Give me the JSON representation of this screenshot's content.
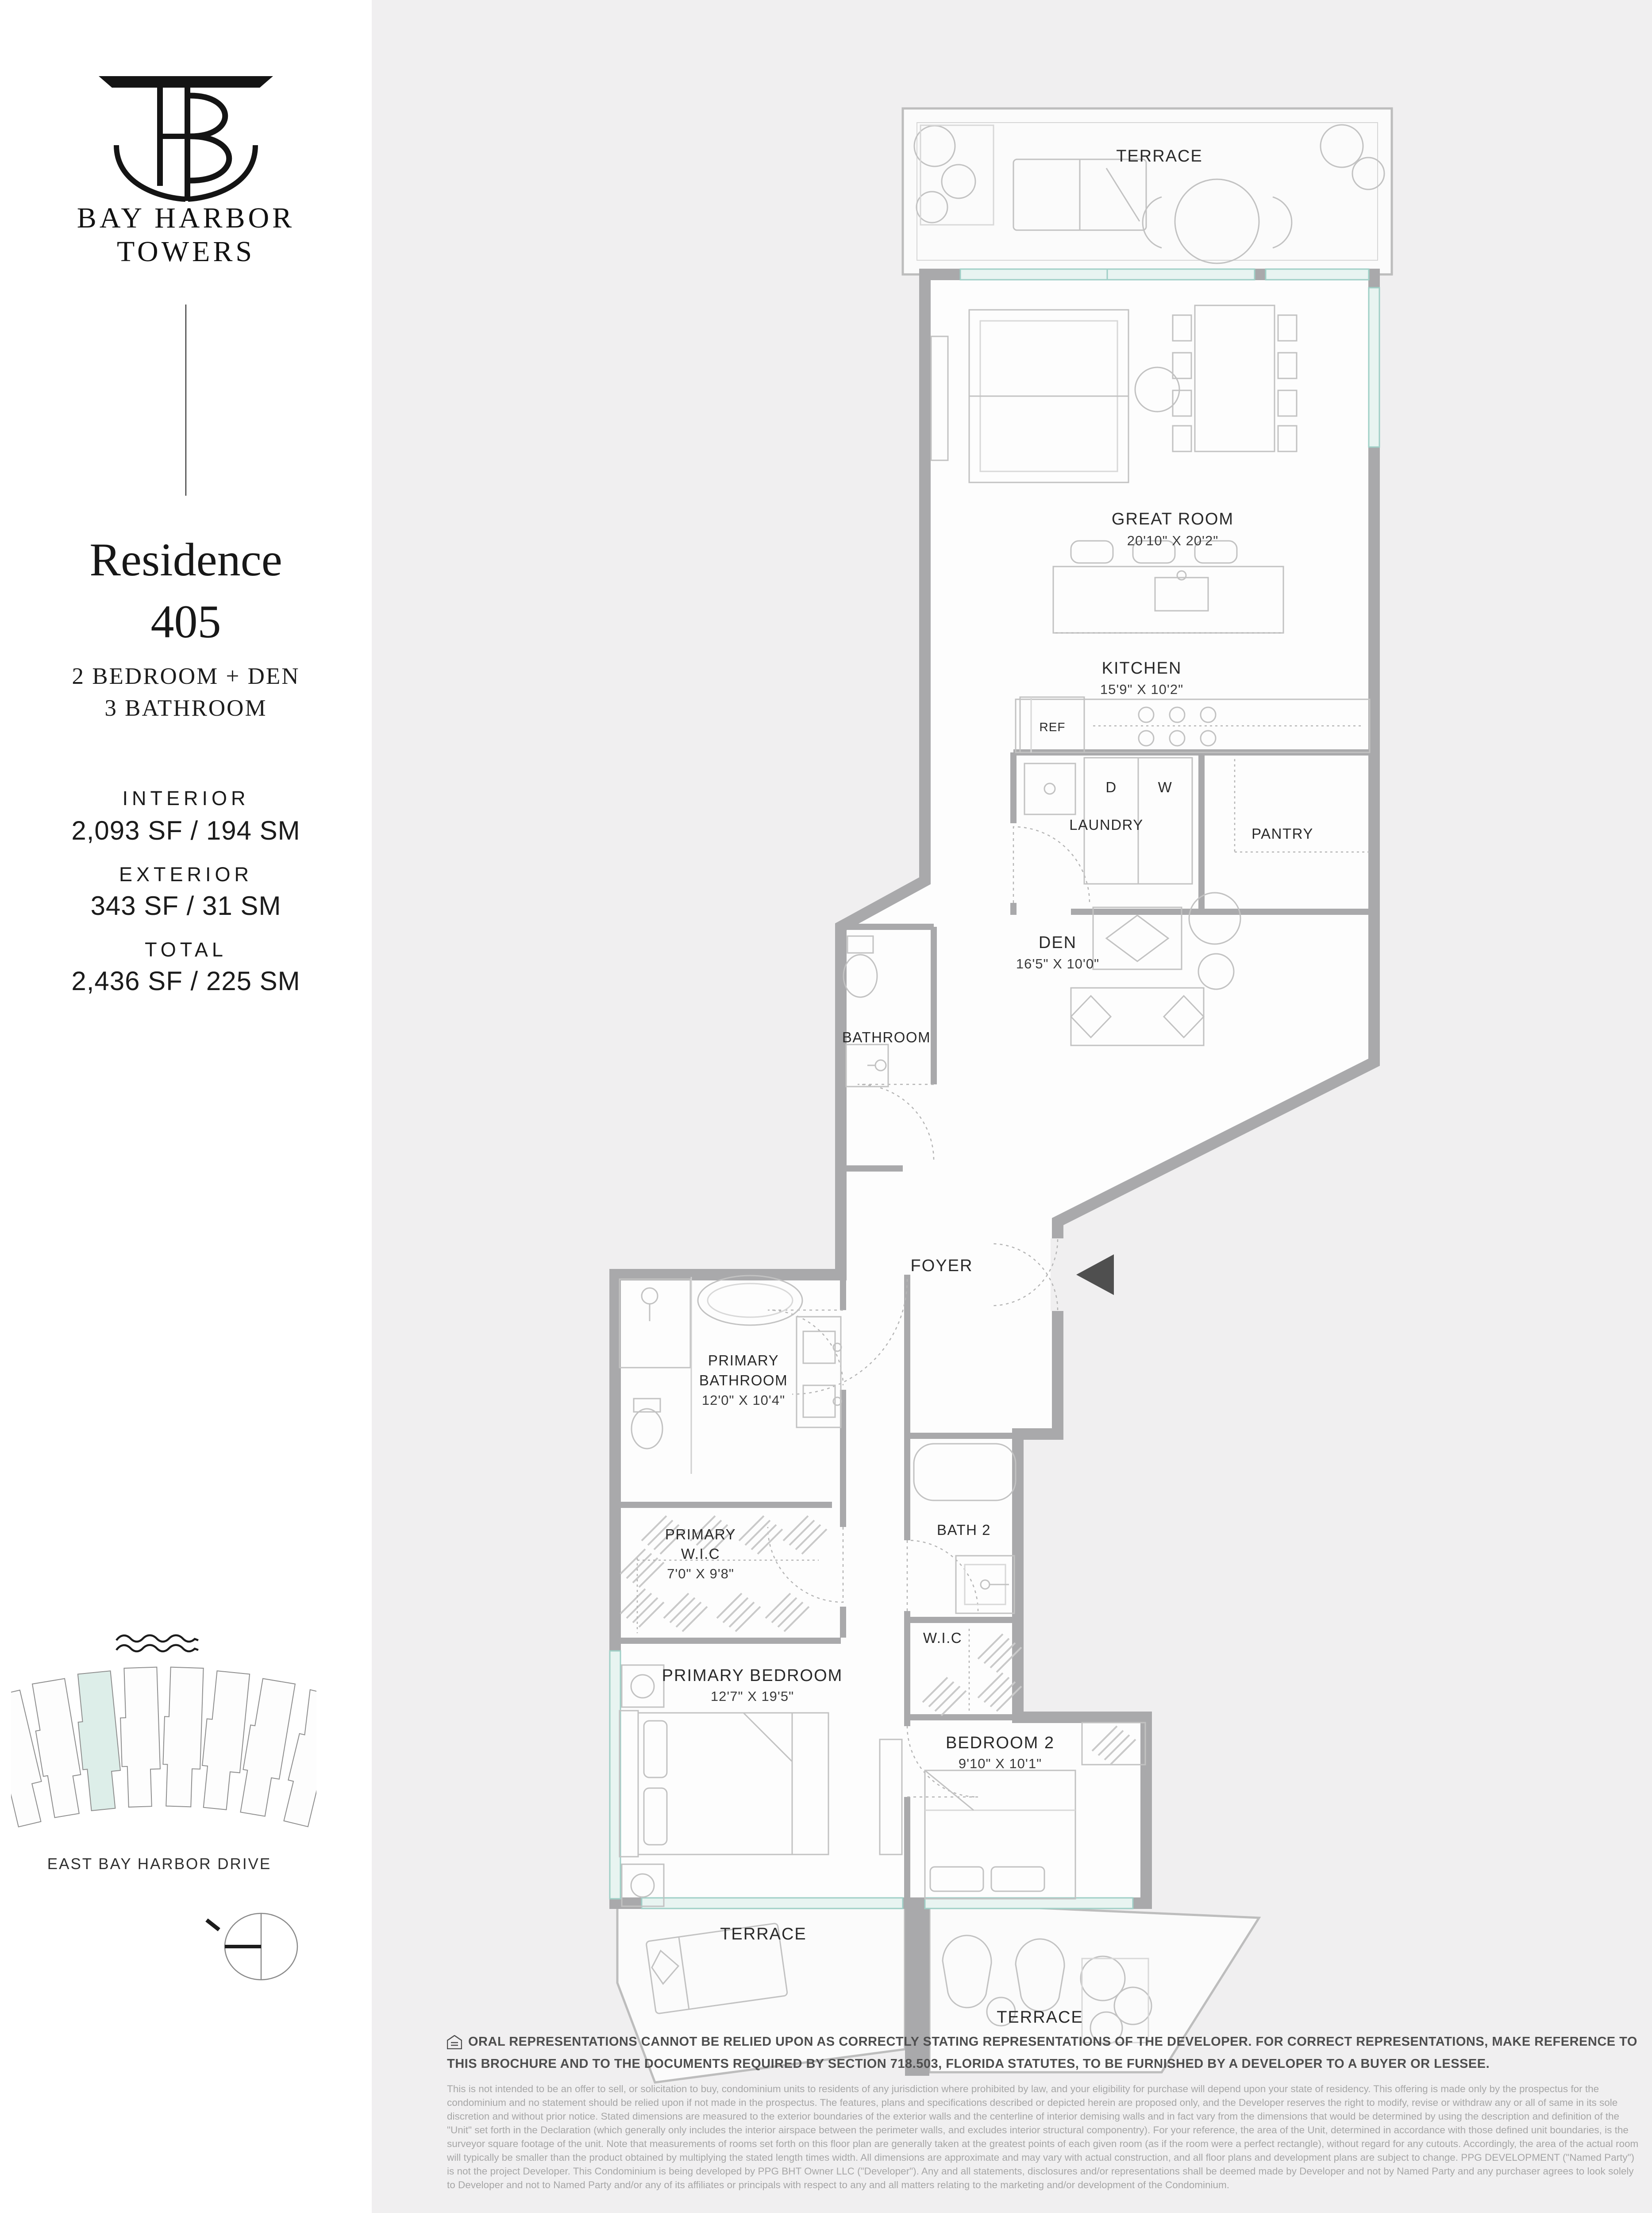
{
  "brand": {
    "line1": "BAY HARBOR",
    "line2": "TOWERS"
  },
  "residence": {
    "name": "Residence",
    "number": "405",
    "config1": "2 BEDROOM + DEN",
    "config2": "3 BATHROOM"
  },
  "stats": {
    "interior_label": "INTERIOR",
    "interior_value": "2,093 SF / 194 SM",
    "exterior_label": "EXTERIOR",
    "exterior_value": "343 SF / 31 SM",
    "total_label": "TOTAL",
    "total_value": "2,436 SF / 225 SM"
  },
  "keyplan": {
    "street": "EAST BAY HARBOR DRIVE",
    "highlight_color": "#ddeee9"
  },
  "rooms": {
    "terrace": "TERRACE",
    "great_room": "GREAT ROOM",
    "great_room_dims": "20'10\" X 20'2\"",
    "kitchen": "KITCHEN",
    "kitchen_dims": "15'9\" X 10'2\"",
    "ref": "REF",
    "dryer": "D",
    "washer": "W",
    "laundry": "LAUNDRY",
    "pantry": "PANTRY",
    "den": "DEN",
    "den_dims": "16'5\" X 10'0\"",
    "bathroom": "BATHROOM",
    "foyer": "FOYER",
    "primary_word": "PRIMARY",
    "primary_bathroom_word": "BATHROOM",
    "primary_bathroom_dims": "12'0\" X 10'4\"",
    "primary_wic_word": "W.I.C",
    "primary_wic_dims": "7'0\" X 9'8\"",
    "primary_bedroom": "PRIMARY BEDROOM",
    "primary_bedroom_dims": "12'7\" X 19'5\"",
    "bath2": "BATH 2",
    "wic": "W.I.C",
    "bedroom2": "BEDROOM 2",
    "bedroom2_dims": "9'10\" X 10'1\""
  },
  "disclaimer": {
    "bold": "ORAL REPRESENTATIONS CANNOT BE RELIED UPON AS CORRECTLY STATING REPRESENTATIONS OF THE DEVELOPER. FOR CORRECT REPRESENTATIONS, MAKE REFERENCE TO THIS BROCHURE AND TO THE DOCUMENTS REQUIRED BY SECTION 718.503, FLORIDA STATUTES, TO BE FURNISHED BY A DEVELOPER TO A BUYER OR LESSEE.",
    "body": "This is not intended to be an offer to sell, or solicitation to buy, condominium units to residents of any jurisdiction where prohibited by law, and your eligibility for purchase will depend upon your state of residency. This offering is made only by the prospectus for the condominium and no statement should be relied upon if not made in the prospectus. The features, plans and specifications described or depicted herein are proposed only, and the Developer reserves the right to modify, revise or withdraw any or all of same in its sole discretion and without prior notice. Stated dimensions are measured to the exterior boundaries of the exterior walls and the centerline of interior demising walls and in fact vary from the dimensions that would be determined by using the description and definition of the \"Unit\" set forth in the Declaration (which generally only includes the interior airspace between the perimeter walls, and excludes interior structural componentry). For your reference, the area of the Unit, determined in accordance with those defined unit boundaries, is the surveyor square footage of the unit. Note that measurements of rooms set forth on this floor plan are generally taken at the greatest points of each given room (as if the room were a perfect rectangle), without regard for any cutouts. Accordingly, the area of the actual room will typically be smaller than the product obtained by multiplying the stated length times width. All dimensions are approximate and may vary with actual construction, and all floor plans and development plans are subject to change. PPG DEVELOPMENT (\"Named Party\") is not the project Developer. This Condominium is being developed by PPG BHT Owner LLC (\"Developer\"). Any and all statements, disclosures and/or representations shall be deemed made by Developer and not by Named Party and any purchaser agrees to look solely to Developer and not to Named Party and/or any of its affiliates or principals with respect to any and all matters relating to the marketing and/or development of the Condominium."
  },
  "colors": {
    "wall_gray": "#a9a9ab",
    "plan_bg": "#f0eff0",
    "glazing_teal": "#9fcfc6"
  }
}
